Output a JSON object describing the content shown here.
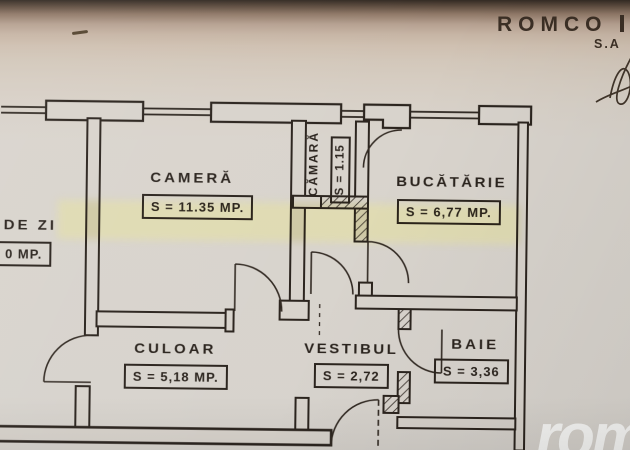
{
  "letterhead": {
    "company": "ROMCO",
    "company_type": "S.A"
  },
  "watermark": "rom",
  "rooms": {
    "camera": {
      "name": "CAMERĂ",
      "area": "S = 11.35 MP."
    },
    "camara": {
      "name": "CĂMARĂ",
      "area": "S = 1.15"
    },
    "bucatarie": {
      "name": "BUCĂTĂRIE",
      "area": "S = 6,77 MP."
    },
    "de_zi": {
      "name": "DE ZI",
      "area": "0 MP."
    },
    "culoar": {
      "name": "CULOAR",
      "area": "S = 5,18 MP."
    },
    "vestibul": {
      "name": "VESTIBUL",
      "area": "S = 2,72"
    },
    "baie": {
      "name": "BAIE",
      "area": "S = 3,36"
    }
  },
  "colors": {
    "ink": "#2b241e",
    "paper": "#d8d3cc",
    "highlighter": "#e8e594",
    "watermark": "#fdfdfc",
    "photo_edge": "#332a23"
  }
}
